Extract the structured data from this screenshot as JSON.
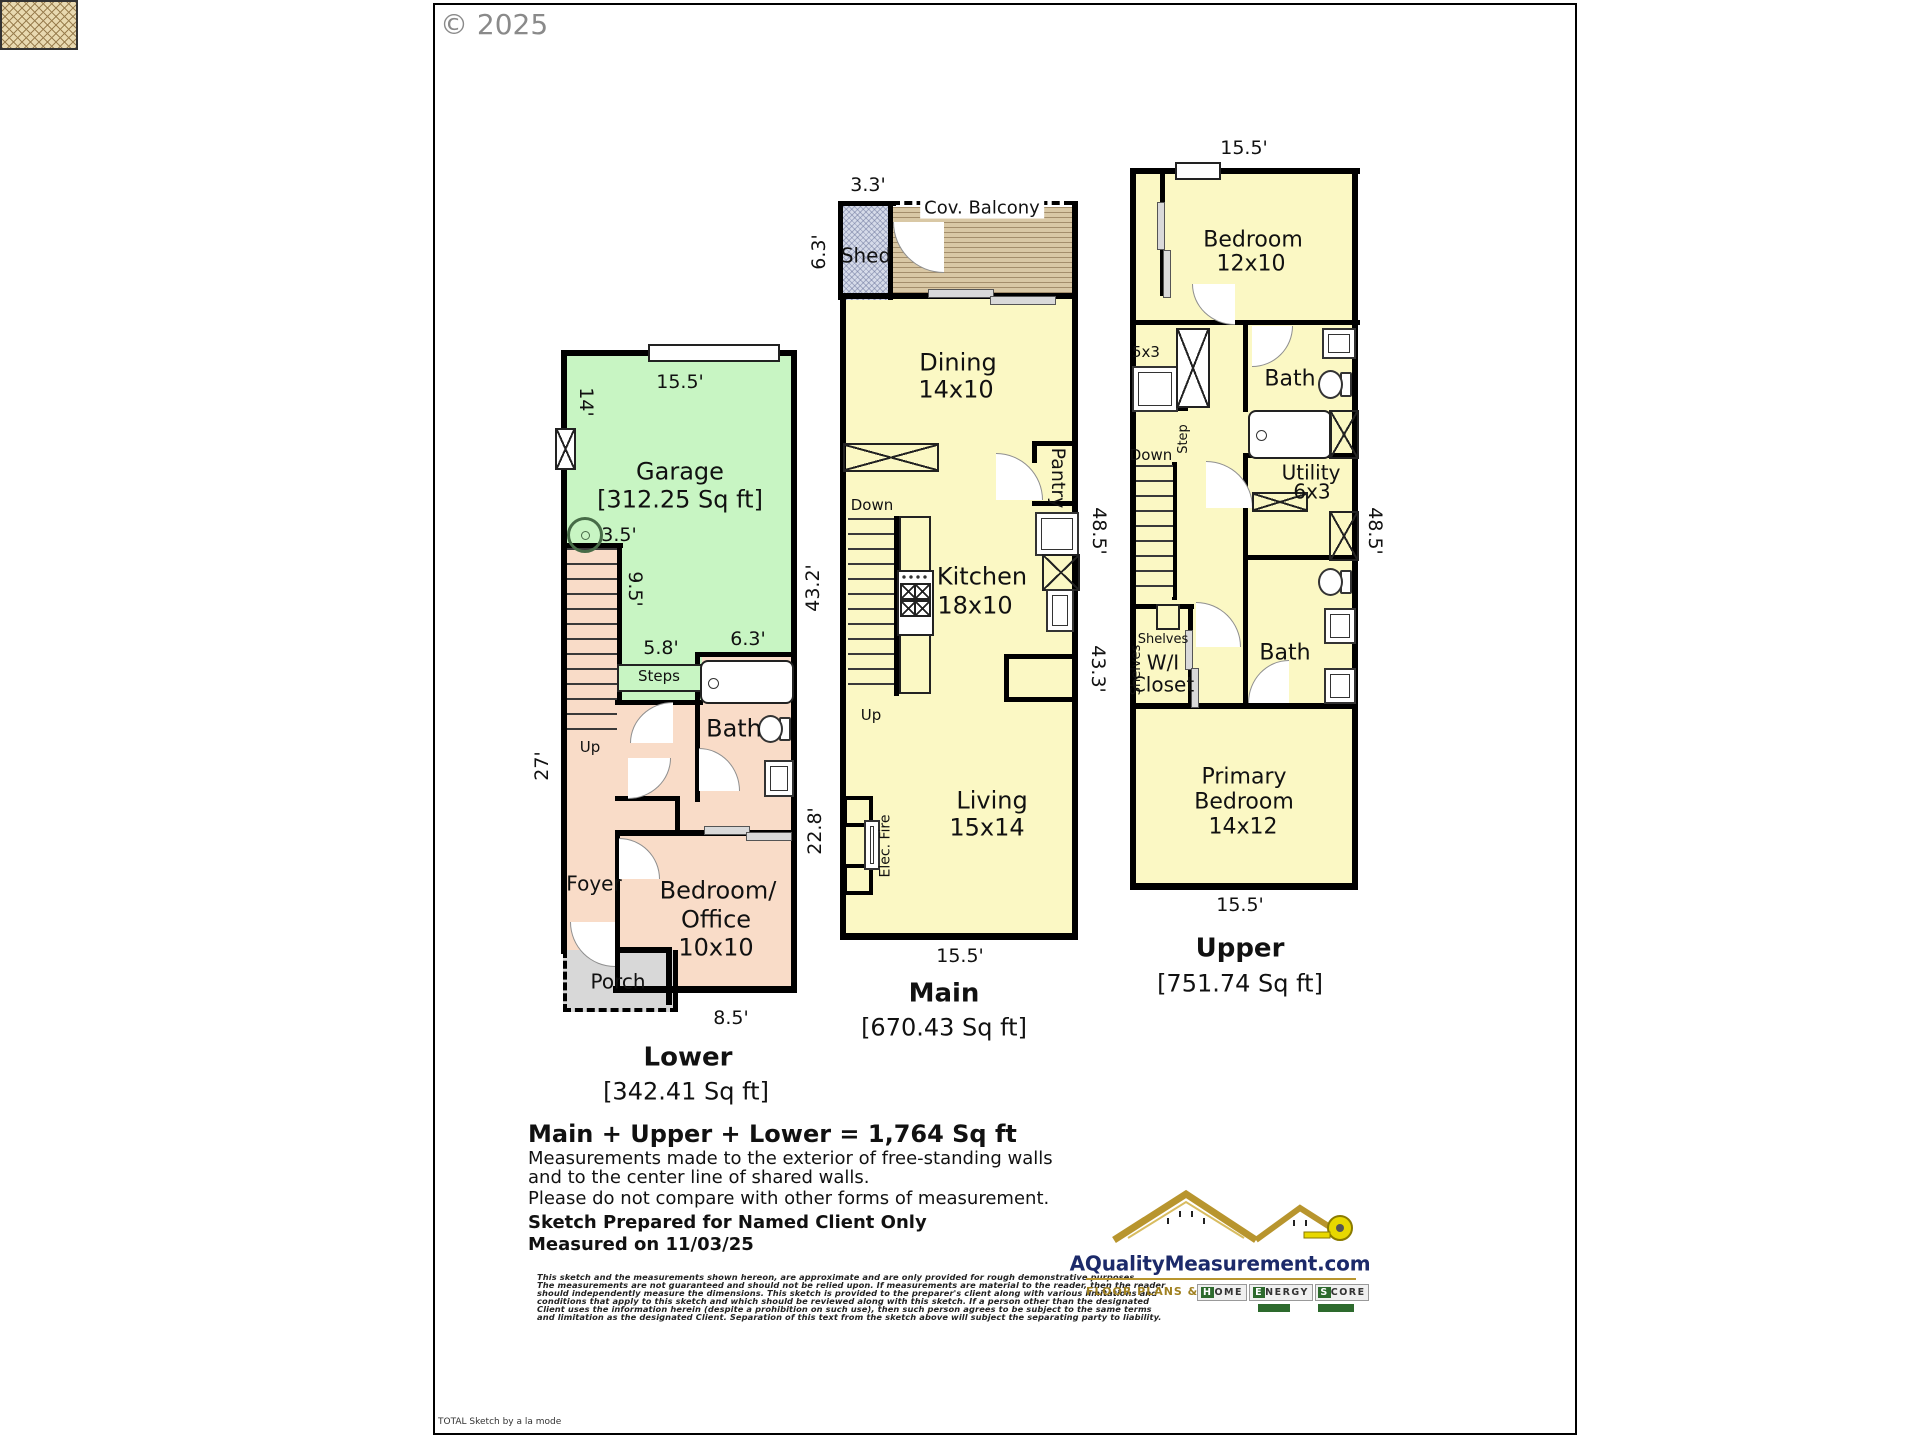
{
  "page": {
    "copyright": "© 2025",
    "brand_footer": "TOTAL Sketch by a la mode",
    "colors": {
      "wall": "#000000",
      "garage_fill": "#c8f5c3",
      "lower_fill": "#f9dcc8",
      "floor_fill": "#fbf8c4",
      "porch_fill": "#d8d8d8",
      "shed_fill": "#d6dbe9",
      "balcony_fill": "#d9c8a5",
      "logo_navy": "#1c2a6a",
      "logo_gold": "#b8952e",
      "badge_green": "#2d6a2d"
    }
  },
  "lower": {
    "title": "Lower",
    "area": "[342.41 Sq ft]",
    "garage": "Garage",
    "garage_area": "[312.25 Sq ft]",
    "bath": "Bath",
    "bedroom1": "Bedroom/",
    "bedroom2": "Office",
    "bedroom3": "10x10",
    "foyer": "Foyer",
    "porch": "Porch",
    "steps": "Steps",
    "up": "Up",
    "dim_top": "15.5'",
    "dim_left_garage": "14'",
    "dim_left": "27'",
    "dim_water": "3.5'",
    "dim_stairs": "9.5'",
    "dim_steps": "5.8'",
    "dim_bath": "6.3'",
    "dim_bottom": "8.5'"
  },
  "main": {
    "title": "Main",
    "area": "[670.43 Sq ft]",
    "shed": "Shed",
    "balcony": "Cov. Balcony",
    "dining1": "Dining",
    "dining2": "14x10",
    "kitchen1": "Kitchen",
    "kitchen2": "18x10",
    "living1": "Living",
    "living2": "15x14",
    "pantry": "Pantry",
    "elec_fire": "Elec. Fire",
    "down": "Down",
    "up": "Up",
    "dim_shed_top": "3.3'",
    "dim_shed_left": "6.3'",
    "dim_left_upper": "43.2'",
    "dim_left_lower": "22.8'",
    "dim_right_upper": "48.5'",
    "dim_right_lower": "43.3'",
    "dim_bottom": "15.5'"
  },
  "upper": {
    "title": "Upper",
    "area": "[751.74 Sq ft]",
    "bedroom1": "Bedroom",
    "bedroom2": "12x10",
    "bath_top": "Bath",
    "bath_bottom": "Bath",
    "utility1": "Utility",
    "utility2": "6x3",
    "closet_dim": "5x3",
    "wic1": "W/I",
    "wic2": "Closet",
    "shelves_h": "Shelves",
    "shelves_v": "Shelves",
    "primary1": "Primary",
    "primary2": "Bedroom",
    "primary3": "14x12",
    "down": "Down",
    "step": "Step",
    "dim_top": "15.5'",
    "dim_right": "48.5'",
    "dim_bottom": "15.5'"
  },
  "footer": {
    "total": "Main + Upper + Lower = 1,764 Sq ft",
    "note1": "Measurements made to the exterior of free-standing walls",
    "note2": "and to the center line of shared walls.",
    "note3": "Please do not compare with other forms of measurement.",
    "prepared": "Sketch Prepared for Named Client Only",
    "measured": "Measured on 11/03/25",
    "disclaimer1": "This sketch and the measurements shown hereon, are approximate and are only provided for rough demonstrative purposes.",
    "disclaimer2": "The measurements are not guaranteed and should not be relied upon.  If measurements are material to the reader, then the reader",
    "disclaimer3": "should independently measure the dimensions.  This sketch is provided to the preparer's client along with various limitations and",
    "disclaimer4": "conditions that apply to this sketch and which should be reviewed along with this sketch.  If a person other than the designated",
    "disclaimer5": "Client uses the information herein (despite a prohibition on such use), then such person agrees to be subject to the same terms",
    "disclaimer6": "and limitation as the designated Client.  Separation of this text from the sketch above will subject the separating party to liability."
  },
  "logo": {
    "site": "AQualityMeasurement.com",
    "tagline": "FLOOR PLANS &",
    "badge1": "HOME",
    "badge2": "ENERGY",
    "badge3": "SCORE"
  }
}
